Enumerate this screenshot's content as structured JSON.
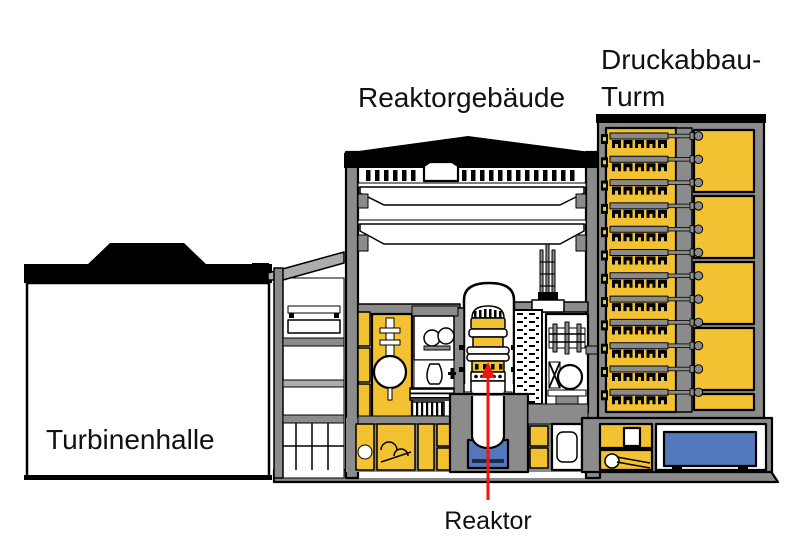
{
  "labels": {
    "turbine_hall": "Turbinenhalle",
    "reactor_building": "Reaktorgebäude",
    "pressure_tower_line1": "Druckabbau-",
    "pressure_tower_line2": "Turm",
    "reactor": "Reaktor"
  },
  "colors": {
    "yellow": "#F2C233",
    "gray": "#8B8B8B",
    "light_gray": "#ACACAC",
    "blue": "#5478BC",
    "red": "#F3140C",
    "black": "#000000",
    "white": "#FFFFFF"
  },
  "tower": {
    "condenser_rows": 12,
    "suppression_panels": 4,
    "small_bottom_panel": true
  },
  "annotation_arrow": {
    "color": "#F3140C",
    "points_to": "Reaktor"
  }
}
